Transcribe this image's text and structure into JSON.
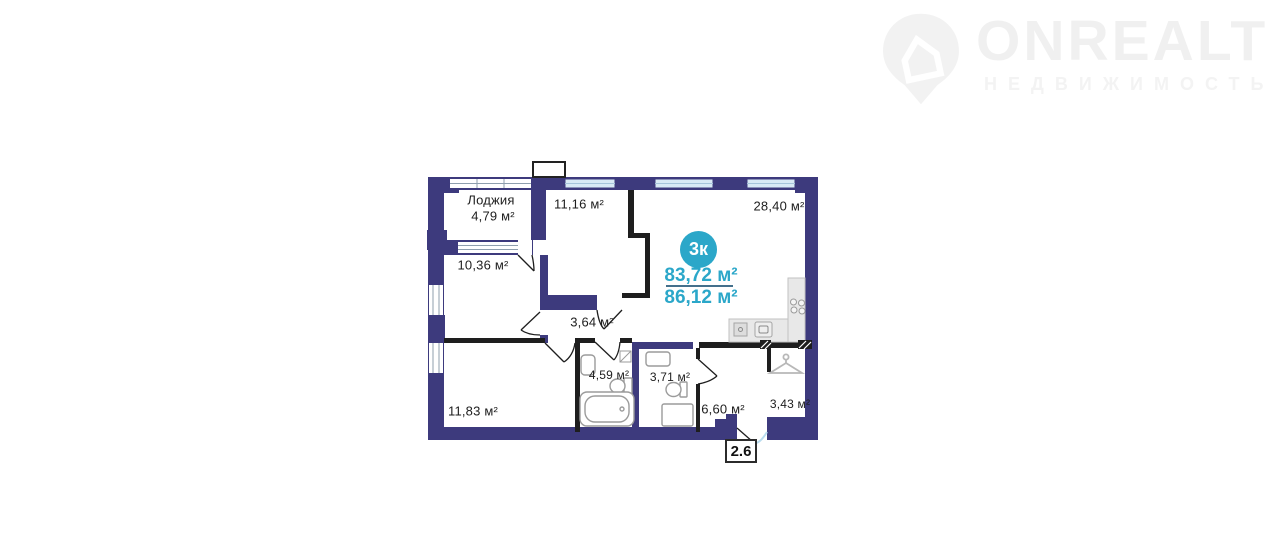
{
  "logo": {
    "brand": "ONREALT",
    "subtitle": "НЕДВИЖИМОСТЬ",
    "icon": "house-pin-icon"
  },
  "plan": {
    "badge": "3к",
    "area_primary": "83,72 м²",
    "area_secondary": "86,12 м²",
    "unit_number": "2.6",
    "rooms": [
      {
        "id": "loggia",
        "label": "Лоджия",
        "area": "4,79 м²"
      },
      {
        "id": "room-11-16",
        "area": "11,16 м²"
      },
      {
        "id": "kitchen-living",
        "area": "28,40 м²"
      },
      {
        "id": "room-10-36",
        "area": "10,36 м²"
      },
      {
        "id": "hall",
        "area": "3,64 м²"
      },
      {
        "id": "bathroom",
        "area": "4,59 м²"
      },
      {
        "id": "toilet",
        "area": "3,71 м²"
      },
      {
        "id": "room-11-83",
        "area": "11,83 м²"
      },
      {
        "id": "corridor",
        "area": "6,60 м²"
      },
      {
        "id": "wardrobe",
        "area": "3,43 м²"
      }
    ],
    "colors": {
      "wall": "#3d3a7d",
      "partition": "#1e1e1e",
      "accent": "#2ba7c9",
      "window": "#d8eaf5"
    }
  }
}
